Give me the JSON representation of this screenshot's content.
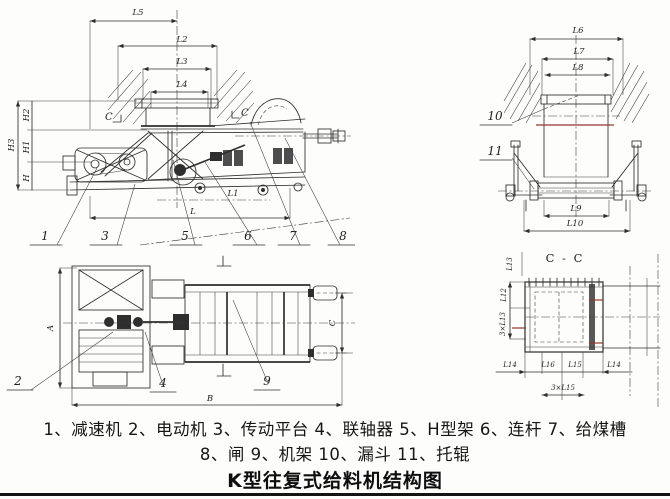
{
  "drawing": {
    "side_view": {
      "dims_top": [
        "L5",
        "L2",
        "L3",
        "L4"
      ],
      "dims_left": [
        "H3",
        "H2",
        "H1",
        "H"
      ],
      "dims_inner": [
        "L1",
        "L"
      ],
      "section_marker_left": "C",
      "section_marker_right": "C",
      "callouts": [
        "1",
        "3",
        "5",
        "6",
        "7",
        "8"
      ]
    },
    "end_view": {
      "dims_top": [
        "L6",
        "L7",
        "L8"
      ],
      "dims_bottom": [
        "L9",
        "L10"
      ],
      "callouts": [
        "10",
        "11"
      ]
    },
    "plan_view": {
      "dim_a": "A",
      "dim_b": "B",
      "dim_c": "C",
      "callouts": [
        "2",
        "4",
        "9"
      ]
    },
    "section_view": {
      "title": "C - C",
      "dim_top_left": "L13",
      "dims_left": [
        "L12",
        "3×L13"
      ],
      "dims_bottom": [
        "L14",
        "L16",
        "L15",
        "L14"
      ],
      "dim_bottom_center": "3×L15"
    },
    "legend_line1": "1、减速机 2、电动机 3、传动平台 4、联轴器 5、H型架 6、连杆 7、给煤槽",
    "legend_line2": "8、闸 9、机架 10、漏斗 11、托辊",
    "title": "K型往复式给料机结构图",
    "colors": {
      "ink": "#2e2e2e",
      "red_line": "#93392c",
      "paper": "#ffffff"
    }
  }
}
